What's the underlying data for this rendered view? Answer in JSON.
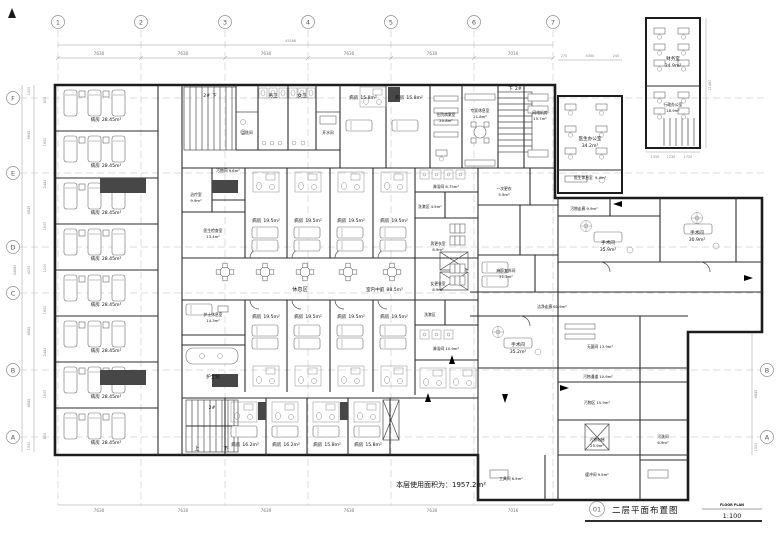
{
  "drawing": {
    "sheet_no": "01",
    "title": "二层平面布置图",
    "subtitle": "FLOOR PLAN",
    "scale": "1:100",
    "area_note": "本层使用面积为：1957.2m²"
  },
  "grid": {
    "cols": [
      "1",
      "2",
      "3",
      "4",
      "5",
      "6",
      "7"
    ],
    "rows_left": [
      "F",
      "E",
      "D",
      "C",
      "B",
      "A"
    ],
    "rows_right": [
      "B",
      "A"
    ],
    "top_dims": [
      "7630",
      "7630",
      "7630",
      "7630",
      "7630",
      "7016"
    ],
    "top_total": "45166",
    "bottom_dims": [
      "7630",
      "7630",
      "7630",
      "7630",
      "7630",
      "7016"
    ],
    "left_dims": [
      "1500",
      "6845",
      "6845",
      "4200",
      "6845",
      "6845",
      "1500"
    ],
    "left_total": "34580",
    "left_subdims": [
      "800",
      "1600",
      "2445",
      "1600",
      "1200",
      "1600",
      "2445",
      "1600",
      "800"
    ],
    "right_dims": [
      "6845",
      "1500"
    ],
    "annex_top_dims": [
      "270",
      "4300",
      "240"
    ],
    "annex_bottom_dims": [
      "1350",
      "1230",
      "1720"
    ],
    "annex_height": "11480"
  },
  "labels": {
    "up": "上",
    "down": "下",
    "stair_no": "2#"
  },
  "rooms": {
    "ward_28": {
      "name": "病房",
      "area": "28.45m²"
    },
    "ward_195": {
      "name": "病房",
      "area": "19.5m²"
    },
    "ward_158": {
      "name": "病房",
      "area": "15.8m²"
    },
    "ward_162": {
      "name": "病房",
      "area": "16.2m²"
    },
    "wc_m": {
      "name": "男卫"
    },
    "wc_f": {
      "name": "女卫"
    },
    "washroom": {
      "name": "盥洗间"
    },
    "hot_water": {
      "name": "开水间"
    },
    "records": {
      "name": "住院病案室",
      "area": "20.8m²"
    },
    "expert_lounge": {
      "name": "专家休息室",
      "area": "21.8m²"
    },
    "network": {
      "name": "网络机房",
      "area": "15.7m²"
    },
    "doctor_office": {
      "name": "医生办公室",
      "area": "34.2m²"
    },
    "doctor_lounge": {
      "name": "医生休息室",
      "area": "9.4m²"
    },
    "finance": {
      "name": "财务室",
      "area": "34.9m²"
    },
    "admin_office": {
      "name": "行政办公室",
      "area": "18.9m²"
    },
    "treatment": {
      "name": "治疗室",
      "area": "9.9m²"
    },
    "soiled_room": {
      "name": "污物间",
      "area": "9.6m²"
    },
    "exam": {
      "name": "医生检查室",
      "area": "13.4m²"
    },
    "rest_area": {
      "name": "休息区"
    },
    "atrium": {
      "name": "室内中庭",
      "area": "88.5m²"
    },
    "nurse_lounge": {
      "name": "护士休息室",
      "area": "14.3m²"
    },
    "nurse_station": {
      "name": "护士站"
    },
    "shower1": {
      "name": "淋浴间",
      "area": "6.75m²"
    },
    "wash_zone": {
      "name": "洗漱区",
      "area": "4.9m²"
    },
    "change_m": {
      "name": "男更衣室",
      "area": "8.9m²"
    },
    "change_f": {
      "name": "女更衣室",
      "area": "8.9m²"
    },
    "shower2": {
      "name": "淋浴间",
      "area": "10.9m²"
    },
    "change_once": {
      "name": "一次更衣",
      "area": "5.9m²"
    },
    "anesthesia": {
      "name": "麻醉复苏间",
      "area": "21.2m²"
    },
    "clean_corr": {
      "name": "洁净走廊",
      "area": "61.9m²"
    },
    "or_b": {
      "name": "手术间",
      "area": "35.2m²"
    },
    "or_1": {
      "name": "手术间",
      "area": "35.9m²"
    },
    "or_2": {
      "name": "手术间",
      "area": "30.9m²"
    },
    "sterile": {
      "name": "无菌间",
      "area": "13.9m²"
    },
    "soiled_corr1": {
      "name": "污物走廊",
      "area": "9.9m²"
    },
    "soiled_corr2": {
      "name": "污物通道",
      "area": "10.9m²"
    },
    "soiled_zone": {
      "name": "污物区",
      "area": "15.9m²"
    },
    "soiled_lift": {
      "name": "污物电梯",
      "area": "25.9m²"
    },
    "buffer": {
      "name": "缓冲间",
      "area": "9.9m²"
    },
    "tool": {
      "name": "工具间",
      "area": "6.9m²"
    },
    "soiled_wash": {
      "name": "污洗间",
      "area": "6.9m²"
    }
  }
}
